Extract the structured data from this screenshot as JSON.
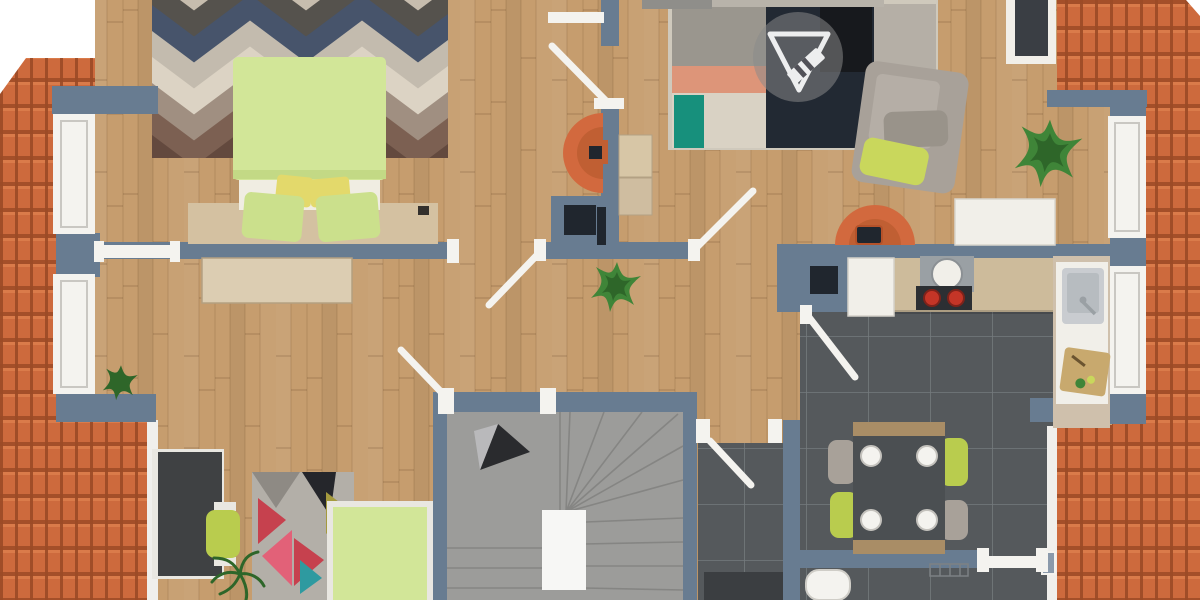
{
  "meta": {
    "description": "Top-down 3D rendered floor plan of an attic storey: terracotta roof slopes left and right, wood flooring, bedroom with lime-green double bed and chevron rug, living area with patchwork rug and gray armchair, kitchen-diner on dark tile with dining table, winder staircase with direction arrow, second bedroom with desk and single bed",
    "watermark_logo": "triangle-and-pencil floor-planner emblem"
  },
  "colors": {
    "page": "#ffffff",
    "wood": "#c69d6e",
    "wood_streak_dark": "#a8possible",
    "roof": "#cd6a3d",
    "roof_dark": "#9c4a26",
    "roof_light": "#dd7f4e",
    "gutter": "#f0efec",
    "wall": "#687c91",
    "frame": "#f4f3ef",
    "frame_inner": "#c9c7c2",
    "tile": "#55595c",
    "tile_line": "#6e7276",
    "stair": "#9c9c9a",
    "stair_line": "#84;8483",
    "landing": "#f7f7f5",
    "bed_green": "#d2e698",
    "bed_fold": "#c3d985",
    "sheet": "#f0ede2",
    "pillow_yellow": "#e3d96b",
    "pillow_green": "#cbe08c",
    "headboard": "#d4c1a1",
    "dresser": "#dccdb2",
    "rug_base": "#c7bdae",
    "chevron_charcoal": "#55524d",
    "chevron_navy": "#47546b",
    "chevron_gray": "#c3bbae",
    "chevron_beige": "#dcd3c4",
    "chevron_taupe": "#a08f81",
    "chevron_brown": "#7c6052",
    "chevron_umber": "#63493e",
    "patch_navy": "#222933",
    "patch_black": "#17191d",
    "patch_gray": "#9a968e",
    "patch_salmon": "#dd9579",
    "patch_beige": "#d9d2c4",
    "patch_teal": "#17907c",
    "patch_tan": "#b5afa6",
    "patch_mint": "#ccd4cd",
    "tri_rug_base": "#b3afa8",
    "tri_red": "#c6414e",
    "tri_pink": "#e26178",
    "tri_black": "#25262b",
    "tri_teal": "#2e9aa0",
    "tri_olive": "#a59a3e",
    "tri_gray": "#8e8a84",
    "sofa_gray": "#a8a199",
    "cushion": "#b5aea6",
    "lime": "#c9d75c",
    "orange_chair": "#d2693e",
    "orange_dark": "#c05f33",
    "desk_dark": "#3f4143",
    "chair_green": "#b9cc4e",
    "counter": "#cdbb9b",
    "appliance_white": "#f1efe9",
    "steel": "#c9ccd0",
    "steel_deep": "#b7bcc0",
    "hood_gray": "#9aa0a4",
    "burner_red": "#c43527",
    "navy_box": "#20262e",
    "table_dark": "#4b4f52",
    "table_trim": "#a98d66",
    "plant": "#3f8538",
    "plant_dark": "#2e6629",
    "board_tan": "#c8a96e",
    "watermark_gray": "#8a8a8a",
    "watermark_white": "#ffffff",
    "couch_gray": "#8f8e8a",
    "couch_beige": "#b8b3aa",
    "cabinet_dark": "#3b3e41"
  },
  "scene": {
    "rooms": [
      {
        "id": "bedroom-top-left",
        "furniture": [
          "double-bed",
          "chevron-rug",
          "headboard-bench",
          "dresser",
          "balcony-windows"
        ]
      },
      {
        "id": "hallway",
        "furniture": [
          "egg-chair",
          "wall-desk-units",
          "utility-niche",
          "potted-plant"
        ]
      },
      {
        "id": "living-area",
        "furniture": [
          "sofa-edge",
          "patchwork-rug",
          "armchair",
          "reading-chair",
          "console-table",
          "tv-sideboard",
          "large-plant",
          "watermark-logo"
        ]
      },
      {
        "id": "kitchen-diner",
        "furniture": [
          "fridge",
          "extractor-hood",
          "cooktop",
          "counter-run",
          "sink-unit",
          "cutting-board",
          "dining-table",
          "green-chairs",
          "gray-chairs",
          "toilet",
          "radiator-sketch"
        ]
      },
      {
        "id": "stairwell",
        "furniture": [
          "winder-stairs",
          "direction-arrow",
          "landing-wall"
        ]
      },
      {
        "id": "bedroom-bottom-left",
        "furniture": [
          "desk",
          "desk-chair",
          "triangle-rug",
          "single-bed",
          "palm-plant"
        ]
      },
      {
        "id": "corridor",
        "furniture": [
          "dark-cabinet"
        ]
      }
    ]
  }
}
